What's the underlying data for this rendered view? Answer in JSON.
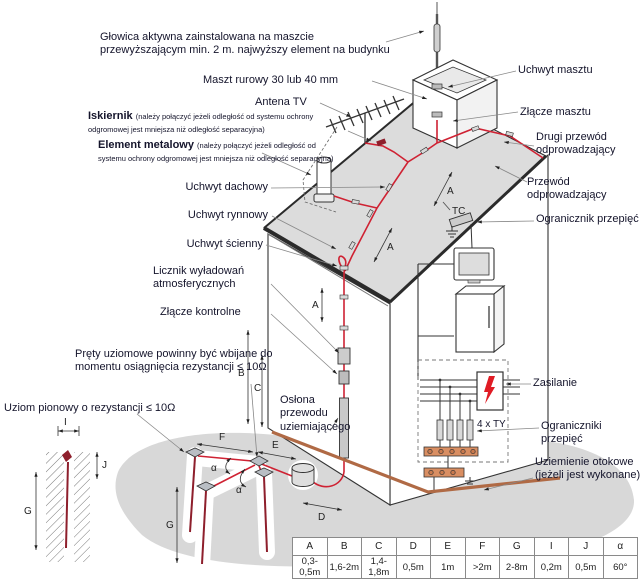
{
  "diagram": {
    "title_context": "Instalacja odgromowa budynku z głowicą aktywną",
    "annotations_left": {
      "glowica": "Głowica aktywna zainstalowana na maszcie przewyższającym min. 2 m. najwyższy element na budynku",
      "maszt": "Maszt rurowy  30 lub 40 mm",
      "antena": "Antena TV",
      "iskiernik": {
        "title": "Iskiernik",
        "note": "(należy połączyć jeżeli odległość od systemu ochrony odgromowej jest mniejsza niż odległość separacyjna)"
      },
      "element": {
        "title": "Element metalowy",
        "note": "(należy połączyć jeżeli odległość od systemu ochrony odgromowej jest mniejsza niż odległość separacyjna)"
      },
      "dachowy": "Uchwyt dachowy",
      "rynnowy": "Uchwyt rynnowy",
      "scienny": "Uchwyt ścienny",
      "licznik": "Licznik wyładowań atmosferycznych",
      "zlacze_kontrolne": "Złącze kontrolne",
      "prety": "Pręty uziomowe powinny być wbijane do momentu osiągnięcia rezystancji ≤ 10Ω",
      "uziom_pionowy": "Uziom pionowy o rezystancji ≤ 10Ω",
      "oslona": "Osłona przewodu uziemiającego"
    },
    "annotations_right": {
      "uchwyt_masztu": "Uchwyt masztu",
      "zlacze_masztu": "Złącze masztu",
      "drugi_przewod": "Drugi przewód odprowadzający",
      "przewod": "Przewód odprowadzający",
      "ogranicznik": "Ogranicznik przepięć",
      "zasilanie": "Zasilanie",
      "four_ty": "4 x TY",
      "ograniczniki": "Ograniczniki przepięć",
      "uziemienie": "Uziemienie otokowe (jeżeli jest wykonane)"
    },
    "inline": {
      "tc": "TC"
    },
    "dims": {
      "a": "A",
      "b": "B",
      "c": "C",
      "d": "D",
      "e": "E",
      "f": "F",
      "g": "G",
      "i": "I",
      "j": "J",
      "alpha": "α"
    }
  },
  "table": {
    "headers": [
      "A",
      "B",
      "C",
      "D",
      "E",
      "F",
      "G",
      "I",
      "J",
      "α"
    ],
    "values": [
      "0,3-0,5m",
      "1,6-2m",
      "1,4-1,8m",
      "0,5m",
      "1m",
      ">2m",
      "2-8m",
      "0,2m",
      "0,5m",
      "60°"
    ]
  },
  "colors": {
    "conductor": "#cf2233",
    "earth_rod": "#8e1f2c",
    "ring_earth": "#b06a45",
    "terminal_strip": "#d98e62",
    "lightning_bolt": "#e01b24",
    "roof": "#dcdcdc",
    "ground": "#d8d8d8"
  }
}
